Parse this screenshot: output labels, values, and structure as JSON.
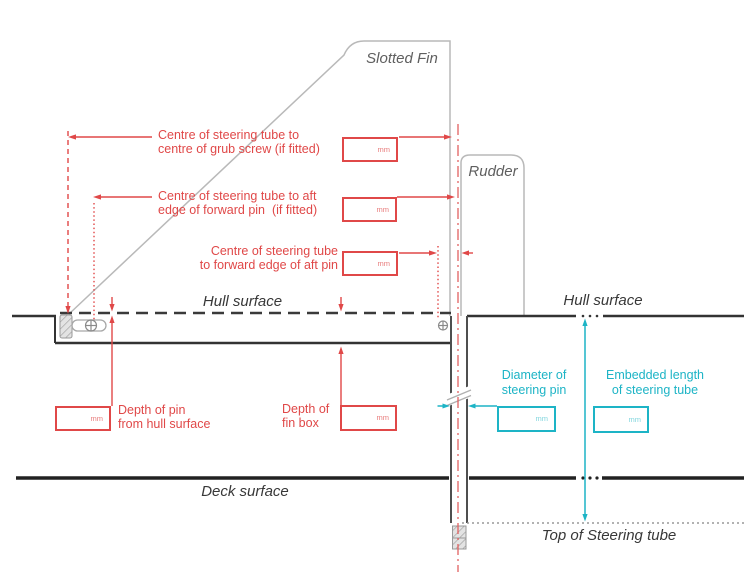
{
  "labels": {
    "slotted_fin": "Slotted Fin",
    "rudder": "Rudder",
    "hull_surface_left": "Hull surface",
    "hull_surface_right": "Hull surface",
    "deck_surface": "Deck surface",
    "top_of_steering_tube": "Top of Steering tube"
  },
  "dimensions": {
    "grub_screw": "Centre of steering tube to\ncentre of grub screw (if fitted)",
    "forward_pin": "Centre of steering tube to aft\nedge of forward pin  (if fitted)",
    "aft_pin": "Centre of steering tube\nto forward edge of aft pin",
    "depth_of_pin": "Depth of pin\nfrom hull surface",
    "depth_of_fin_box": "Depth of\nfin box",
    "steering_pin_diameter": "Diameter of\nsteering pin",
    "embedded_length": "Embedded length\nof steering tube"
  },
  "unit": "mm",
  "colors": {
    "red_annotation": "#e04848",
    "cyan_annotation": "#1db4c6",
    "structure_dark": "#333333",
    "outline_gray": "#b9b9b9"
  }
}
